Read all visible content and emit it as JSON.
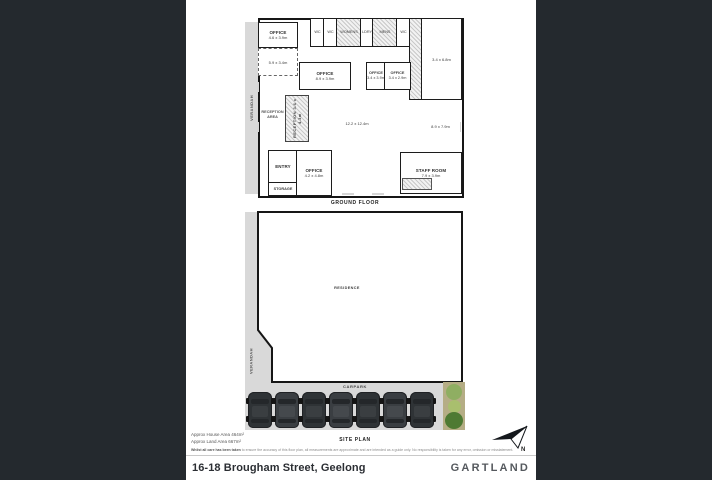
{
  "ground_floor": {
    "caption": "GROUND FLOOR",
    "verandah": "VERANDAH",
    "office_tl": {
      "name": "OFFICE",
      "dims": "4.6 x 3.9m"
    },
    "open_area": "5.9 x 3.4m",
    "top_rooms": [
      "WC",
      "WC",
      "WOMENS",
      "LDRY",
      "MENS",
      "WC"
    ],
    "office_mid": {
      "name": "OFFICE",
      "dims": "8.9 x 3.9m"
    },
    "office_a": {
      "name": "OFFICE",
      "dims": "3.4 x 3.9m"
    },
    "office_b": {
      "name": "OFFICE",
      "dims": "3.4 x 2.9m"
    },
    "room_right": "3.4 x 6.8m",
    "reception_area": "RECEPTION AREA",
    "reception_desk": "RECEPTION 3.6 x 4.3m",
    "centre": "12.2 x 12.4m",
    "open_right": "8.9 x 7.9m",
    "entry": "ENTRY",
    "storage": "STORAGE",
    "office_c": {
      "name": "OFFICE",
      "dims": "4.2 x 4.8m"
    },
    "staff": {
      "name": "STAFF ROOM",
      "dims": "7.9 x 3.9m"
    }
  },
  "site_plan": {
    "caption": "SITE PLAN",
    "residence": "RESIDENCE",
    "verandah": "VERANDAH",
    "carpark": "CARPARK",
    "car_count": 7
  },
  "footer": {
    "house_area": "Approx House Area 464m²",
    "land_area": "Approx Land Area 667m²",
    "disclaimer_bold": "Whilst all care has been taken",
    "disclaimer": " to ensure the accuracy of this floor plan, all measurements are approximate and are intended as a guide only. No responsibility is taken for any error, omission or misstatement.",
    "north_label": "N",
    "address": "16-18 Brougham Street, Geelong",
    "brand": "GARTLAND"
  }
}
